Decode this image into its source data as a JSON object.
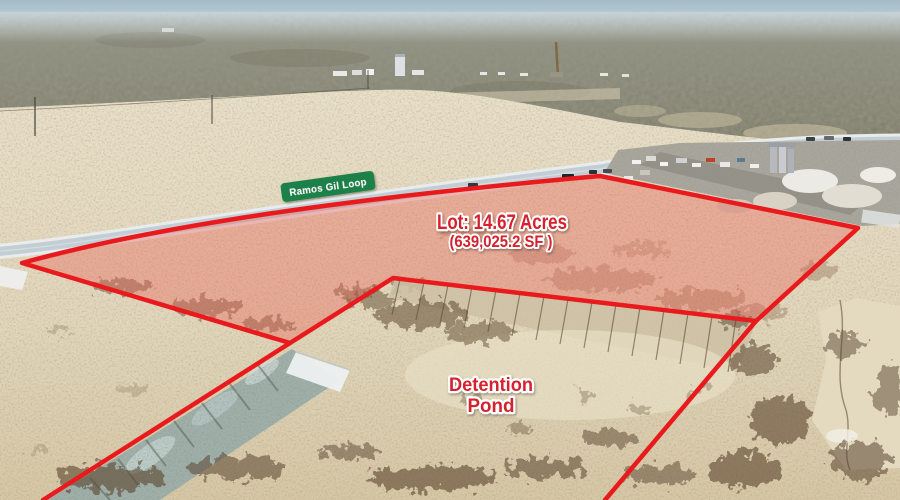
{
  "photo": {
    "road_sign": {
      "label": "Ramos Gil Loop",
      "bg_color": "#1c8048",
      "text_color": "#ffffff"
    },
    "lot_label": {
      "line1": "Lot: 14.67 Acres",
      "line2": "(639,025.2 SF )",
      "text_color": "#d4202e",
      "outline_color": "#ffffff"
    },
    "detention_label": {
      "line1": "Detention",
      "line2": "Pond",
      "text_color": "#d4202e",
      "outline_color": "#ffffff"
    },
    "boundary": {
      "color": "#e91a1d"
    }
  }
}
